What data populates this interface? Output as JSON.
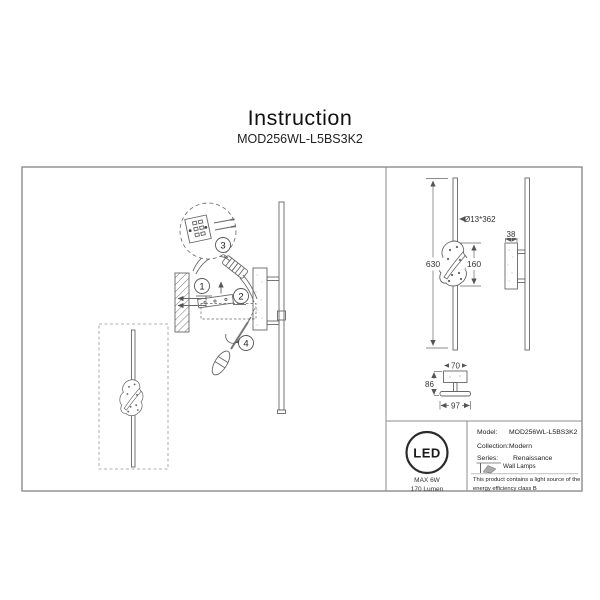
{
  "page": {
    "title": "Instruction",
    "subtitle": "MOD256WL-L5BS3K2"
  },
  "installation": {
    "steps": [
      "1",
      "2",
      "3",
      "4"
    ]
  },
  "dimensions": {
    "overall_height": "630",
    "tube": "Ø13*362",
    "decor_height": "160",
    "depth": "38",
    "bracket_width": "70",
    "bracket_height": "86",
    "base_width": "97"
  },
  "led_badge": {
    "logo": "LED",
    "max_power": "MAX 6W",
    "luminous_flux": "170 Lumen"
  },
  "spec_table": {
    "model_label": "Model:",
    "model_value": "MOD256WL-L5BS3K2",
    "collection_label": "Collection:",
    "collection_value": "Modern",
    "series_label": "Series:",
    "series_value": "Renaissance",
    "category_value": "Wall Lamps",
    "note": "This product contains a light source of the energy efficiency class B"
  },
  "colors": {
    "line": "#666666",
    "border": "#8c8c8c",
    "text": "#1a1a1a"
  }
}
